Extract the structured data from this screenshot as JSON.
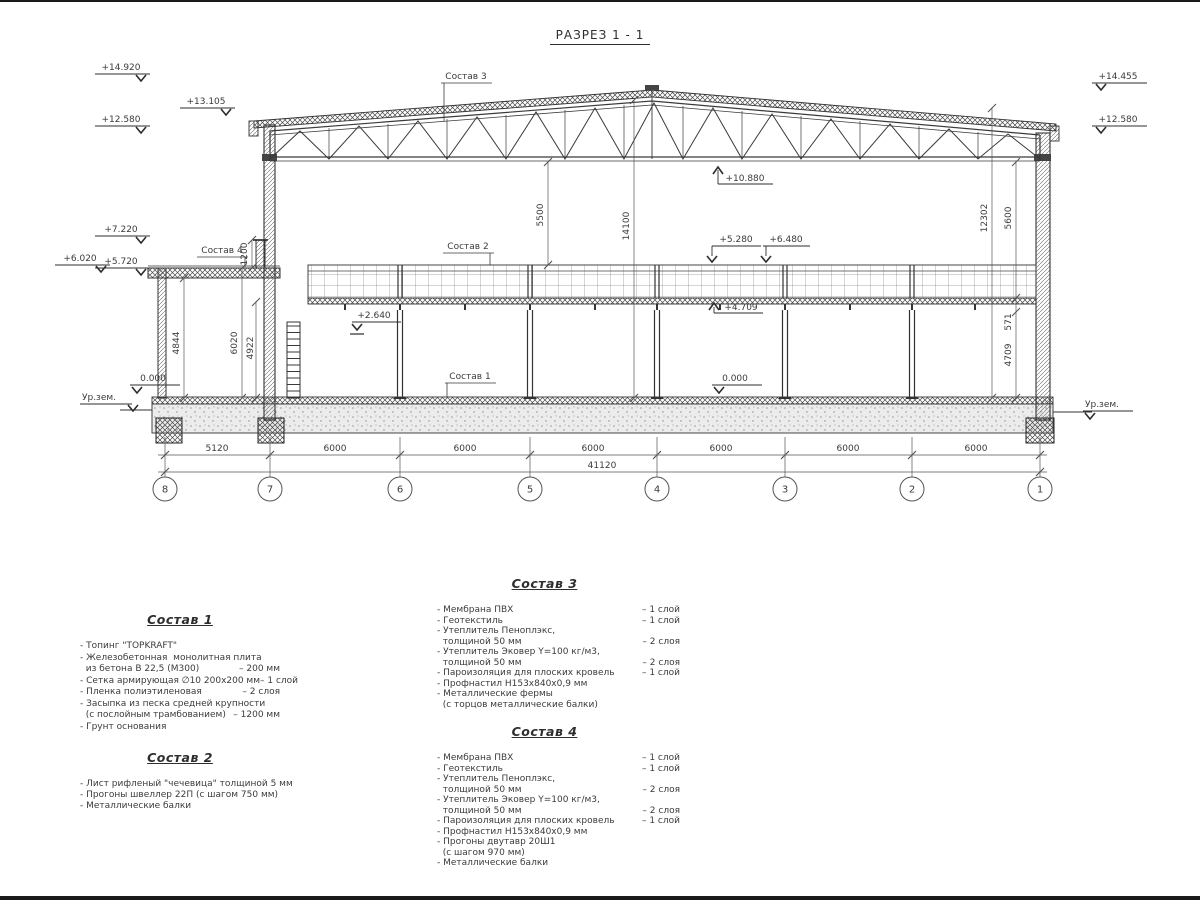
{
  "title": "РАЗРЕЗ 1 - 1",
  "labels": {
    "ground": "Ур.зем.",
    "sostav1_tag": "Состав 1",
    "sostav2_tag": "Состав 2",
    "sostav3_tag": "Состав 3",
    "sostav4_tag": "Состав 4"
  },
  "elevations": {
    "left": [
      "+14.920",
      "+13.105",
      "+12.580",
      "+7.220",
      "+6.020",
      "+5.720"
    ],
    "right": [
      "+14.455",
      "+12.580"
    ],
    "internal": [
      "+10.880",
      "+5.280",
      "+6.480",
      "+4.709",
      "+2.640",
      "0.000",
      "0.000"
    ]
  },
  "dims": {
    "spans": [
      "5120",
      "6000",
      "6000",
      "6000",
      "6000",
      "6000",
      "6000"
    ],
    "total": "41120",
    "vertical": {
      "parapet": "1200",
      "annex_a": "4844",
      "annex_b": "6020",
      "annex_c": "4922",
      "truss_to_platform": "5500",
      "hall_height": "14100",
      "right_a": "12302",
      "right_b": "5600",
      "beam": "571",
      "under_beam": "4709"
    }
  },
  "grid": [
    "8",
    "7",
    "6",
    "5",
    "4",
    "3",
    "2",
    "1"
  ],
  "comp1": {
    "title": "Состав 1",
    "rows": [
      {
        "t": "- Топинг \"TOPKRAFT\"",
        "v": ""
      },
      {
        "t": "- Железобетонная  монолитная плита",
        "v": ""
      },
      {
        "t": "  из бетона В 22,5 (М300)",
        "v": "– 200 мм"
      },
      {
        "t": "- Сетка армирующая ∅10 200х200 мм",
        "v": "– 1 слой"
      },
      {
        "t": "- Пленка полиэтиленовая",
        "v": "– 2 слоя"
      },
      {
        "t": "- Засыпка из песка средней крупности",
        "v": ""
      },
      {
        "t": "  (с послойным трамбованием)",
        "v": "– 1200 мм"
      },
      {
        "t": "- Грунт основания",
        "v": ""
      }
    ]
  },
  "comp2": {
    "title": "Состав 2",
    "rows": [
      {
        "t": "- Лист рифленый \"чечевица\" толщиной 5 мм",
        "v": ""
      },
      {
        "t": "- Прогоны швеллер 22П (с шагом 750 мм)",
        "v": ""
      },
      {
        "t": "- Металлические балки",
        "v": ""
      }
    ]
  },
  "comp3": {
    "title": "Состав 3",
    "rows": [
      {
        "t": "- Мембрана ПВХ",
        "v": "– 1 слой"
      },
      {
        "t": "- Геотекстиль",
        "v": "– 1 слой"
      },
      {
        "t": "- Утеплитель Пеноплэкс,",
        "v": ""
      },
      {
        "t": "  толщиной 50 мм",
        "v": "– 2 слоя"
      },
      {
        "t": "- Утеплитель Эковер Y=100 кг/м3,",
        "v": ""
      },
      {
        "t": "  толщиной 50 мм",
        "v": "– 2 слоя"
      },
      {
        "t": "- Пароизоляция для плоских кровель",
        "v": "– 1 слой"
      },
      {
        "t": "- Профнастил Н153х840х0,9 мм",
        "v": ""
      },
      {
        "t": "- Металлические фермы",
        "v": ""
      },
      {
        "t": "  (с торцов металлические балки)",
        "v": ""
      }
    ]
  },
  "comp4": {
    "title": "Состав 4",
    "rows": [
      {
        "t": "- Мембрана ПВХ",
        "v": "– 1 слой"
      },
      {
        "t": "- Геотекстиль",
        "v": "– 1 слой"
      },
      {
        "t": "- Утеплитель Пеноплэкс,",
        "v": ""
      },
      {
        "t": "  толщиной 50 мм",
        "v": "– 2 слоя"
      },
      {
        "t": "- Утеплитель Эковер Y=100 кг/м3,",
        "v": ""
      },
      {
        "t": "  толщиной 50 мм",
        "v": "– 2 слоя"
      },
      {
        "t": "- Пароизоляция для плоских кровель",
        "v": "– 1 слой"
      },
      {
        "t": "- Профнастил Н153х840х0,9 мм",
        "v": ""
      },
      {
        "t": "- Прогоны двутавр 20Ш1",
        "v": ""
      },
      {
        "t": "  (с шагом 970 мм)",
        "v": ""
      },
      {
        "t": "- Металлические балки",
        "v": ""
      }
    ]
  }
}
